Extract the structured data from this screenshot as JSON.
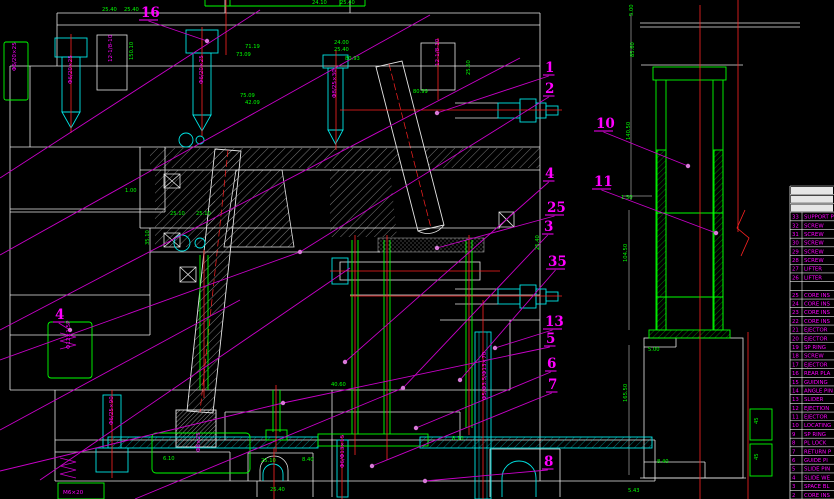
{
  "drawing": {
    "title": "injection-mold-assembly-section-view",
    "background": "#000000",
    "colors": {
      "outline": "#e6e6e6",
      "component": "#00e5e5",
      "dimension_text": "#00ff00",
      "centerline": "#ff2222",
      "annotation": "#ff00ff",
      "leader": "#c800c8"
    },
    "callouts": [
      {
        "label": "16",
        "x": 141,
        "y": 6,
        "tx": 207,
        "ty": 41
      },
      {
        "label": "1",
        "x": 545,
        "y": 61,
        "tx": 437,
        "ty": 113
      },
      {
        "label": "2",
        "x": 545,
        "y": 82,
        "tx": 300,
        "ty": 252,
        "ext": [
          0,
          360
        ]
      },
      {
        "label": "10",
        "x": 596,
        "y": 117,
        "tx": 688,
        "ty": 166
      },
      {
        "label": "4",
        "x": 545,
        "y": 167,
        "tx": 345,
        "ty": 362
      },
      {
        "label": "11",
        "x": 594,
        "y": 175,
        "tx": 716,
        "ty": 233
      },
      {
        "label": "25",
        "x": 547,
        "y": 201,
        "tx": 437,
        "ty": 248
      },
      {
        "label": "3",
        "x": 544,
        "y": 220,
        "tx": 403,
        "ty": 388,
        "ext": [
          135,
          499
        ]
      },
      {
        "label": "35",
        "x": 548,
        "y": 255,
        "tx": 460,
        "ty": 380
      },
      {
        "label": "13",
        "x": 545,
        "y": 315,
        "tx": 495,
        "ty": 348
      },
      {
        "label": "5",
        "x": 546,
        "y": 332,
        "tx": 283,
        "ty": 403,
        "ext": [
          0,
          471
        ]
      },
      {
        "label": "6",
        "x": 547,
        "y": 357,
        "tx": 416,
        "ty": 428
      },
      {
        "label": "7",
        "x": 548,
        "y": 378,
        "tx": 372,
        "ty": 466
      },
      {
        "label": "8",
        "x": 544,
        "y": 455,
        "tx": 425,
        "ty": 481
      },
      {
        "label": "4",
        "x": 55,
        "y": 308,
        "tx": 70,
        "ty": 330
      }
    ],
    "dimensions": [
      {
        "t": "25.40",
        "x": 102,
        "y": 11
      },
      {
        "t": "25.40",
        "x": 124,
        "y": 11
      },
      {
        "t": "24.10",
        "x": 312,
        "y": 4
      },
      {
        "t": "25.40",
        "x": 340,
        "y": 4
      },
      {
        "t": "71.19",
        "x": 245,
        "y": 48
      },
      {
        "t": "73.09",
        "x": 236,
        "y": 56
      },
      {
        "t": "75.09",
        "x": 240,
        "y": 97
      },
      {
        "t": "42.09",
        "x": 245,
        "y": 104
      },
      {
        "t": "150.10",
        "x": 133,
        "y": 60,
        "r": -90
      },
      {
        "t": "24.00",
        "x": 334,
        "y": 44
      },
      {
        "t": "25.40",
        "x": 334,
        "y": 51
      },
      {
        "t": "80.93",
        "x": 345,
        "y": 60
      },
      {
        "t": "80.99",
        "x": 413,
        "y": 93
      },
      {
        "t": "25.60",
        "x": 470,
        "y": 75,
        "r": -90
      },
      {
        "t": "25.40",
        "x": 539,
        "y": 250,
        "r": -90
      },
      {
        "t": "1.00",
        "x": 125,
        "y": 192
      },
      {
        "t": "25.10",
        "x": 170,
        "y": 215
      },
      {
        "t": "25.10",
        "x": 196,
        "y": 215
      },
      {
        "t": "35.10",
        "x": 149,
        "y": 245,
        "r": -90
      },
      {
        "t": "40.60",
        "x": 331,
        "y": 386
      },
      {
        "t": "6.10",
        "x": 163,
        "y": 460
      },
      {
        "t": "25.10",
        "x": 261,
        "y": 462
      },
      {
        "t": "8.40",
        "x": 302,
        "y": 461
      },
      {
        "t": "25.40",
        "x": 270,
        "y": 491
      },
      {
        "t": "8.10",
        "x": 452,
        "y": 440
      },
      {
        "t": "5.00",
        "x": 633,
        "y": 16,
        "r": -90
      },
      {
        "t": "85.60",
        "x": 634,
        "y": 57,
        "r": -90
      },
      {
        "t": "140.50",
        "x": 630,
        "y": 140,
        "r": -90
      },
      {
        "t": "1.50",
        "x": 621,
        "y": 199
      },
      {
        "t": "104.50",
        "x": 627,
        "y": 262,
        "r": -90
      },
      {
        "t": "5.00",
        "x": 648,
        "y": 351
      },
      {
        "t": "165.50",
        "x": 627,
        "y": 402,
        "r": -90
      },
      {
        "t": "8.40",
        "x": 657,
        "y": 463
      },
      {
        "t": "5.43",
        "x": 628,
        "y": 492
      },
      {
        "t": "45",
        "x": 758,
        "y": 424,
        "r": -90
      },
      {
        "t": "45",
        "x": 758,
        "y": 460,
        "r": -90
      }
    ],
    "specs": [
      {
        "t": "Φ6/20×25",
        "x": 16,
        "y": 71
      },
      {
        "t": "Φ6/20×25",
        "x": 72,
        "y": 84
      },
      {
        "t": "12-1/8-10",
        "x": 112,
        "y": 62
      },
      {
        "t": "Φ6/20×25",
        "x": 203,
        "y": 84
      },
      {
        "t": "Φ8/25×30",
        "x": 336,
        "y": 98
      },
      {
        "t": "12-1/8-10",
        "x": 439,
        "y": 66
      },
      {
        "t": "Φ12×1.5P",
        "x": 70,
        "y": 349
      },
      {
        "t": "Φ6/25×90",
        "x": 113,
        "y": 425
      },
      {
        "t": "Φ8×25",
        "x": 200,
        "y": 452
      },
      {
        "t": "Φ6/Φ13×15",
        "x": 344,
        "y": 468
      },
      {
        "t": "Φ5/Φ3.5/Φ13×70",
        "x": 486,
        "y": 400
      },
      {
        "t": "M6×20",
        "x": 63,
        "y": 494,
        "r": 0
      }
    ],
    "bom": {
      "rows": [
        {
          "no": "33",
          "name": "SUPPORT P"
        },
        {
          "no": "32",
          "name": "SCREW"
        },
        {
          "no": "31",
          "name": "SCREW"
        },
        {
          "no": "30",
          "name": "SCREW"
        },
        {
          "no": "29",
          "name": "SCREW"
        },
        {
          "no": "28",
          "name": "SCREW"
        },
        {
          "no": "27",
          "name": "LIFTER"
        },
        {
          "no": "26",
          "name": "LIFTER"
        },
        {
          "no": "",
          "name": ""
        },
        {
          "no": "25",
          "name": "CORE INS"
        },
        {
          "no": "24",
          "name": "CORE INS"
        },
        {
          "no": "23",
          "name": "CORE INS"
        },
        {
          "no": "22",
          "name": "CORE INS"
        },
        {
          "no": "21",
          "name": "EJECTOR"
        },
        {
          "no": "20",
          "name": "EJECTOR"
        },
        {
          "no": "19",
          "name": "SP RING"
        },
        {
          "no": "18",
          "name": "SCREW"
        },
        {
          "no": "17",
          "name": "EJECTOR"
        },
        {
          "no": "16",
          "name": "REAR PLA"
        },
        {
          "no": "15",
          "name": "GUIDING"
        },
        {
          "no": "14",
          "name": "ANGLE PIN"
        },
        {
          "no": "13",
          "name": "SLIDER"
        },
        {
          "no": "12",
          "name": "EJECTION"
        },
        {
          "no": "11",
          "name": "EJECTOR"
        },
        {
          "no": "10",
          "name": "LOCATING"
        },
        {
          "no": "9",
          "name": "SP RING"
        },
        {
          "no": "8",
          "name": "PL LOCK"
        },
        {
          "no": "7",
          "name": "RETURN P"
        },
        {
          "no": "6",
          "name": "GUIDE PI"
        },
        {
          "no": "5",
          "name": "SLIDE PIN"
        },
        {
          "no": "4",
          "name": "SLIDE WE"
        },
        {
          "no": "3",
          "name": "SPACE BL"
        },
        {
          "no": "2",
          "name": "CORE INS"
        }
      ]
    }
  }
}
